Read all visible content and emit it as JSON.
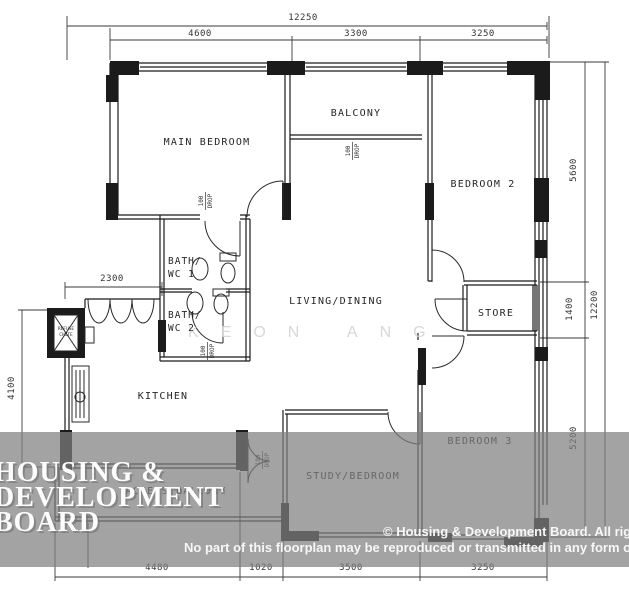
{
  "plan": {
    "rooms": {
      "main_bedroom": "MAIN BEDROOM",
      "balcony": "BALCONY",
      "bedroom2": "BEDROOM 2",
      "living": "LIVING/DINING",
      "store": "STORE",
      "kitchen": "KITCHEN",
      "bedroom3": "BEDROOM 3",
      "study": "STUDY/BEDROOM",
      "access_balcony": "ACCESS BALCONY",
      "bath1_line1": "BATH/",
      "bath1_line2": "WC 1",
      "bath2_line1": "BATH/",
      "bath2_line2": "WC 2"
    },
    "notes": {
      "drop_value": "100",
      "drop_word": "DROP",
      "refuse_line1": "REFUSE",
      "refuse_line2": "CHUTE"
    },
    "dimensions": {
      "top_overall": "12250",
      "top_seg1": "4600",
      "top_seg2": "3300",
      "top_seg3": "3250",
      "right_seg1": "5600",
      "right_seg2": "1400",
      "right_seg3": "5200",
      "right_overall": "12200",
      "left_width": "2300",
      "left_height": "4100",
      "bottom_seg1": "4480",
      "bottom_seg2": "1020",
      "bottom_seg3": "3500",
      "bottom_seg4": "3250"
    }
  },
  "watermark": {
    "line1": "HOUSING &",
    "line2": "DEVELOPMENT",
    "line3": "BOARD",
    "agent": "KEON ANG"
  },
  "copyright": {
    "line1": "© Housing & Development Board. All rights",
    "line2": "No part of this floorplan may be reproduced or transmitted in any form or by a"
  },
  "colors": {
    "wall": "#1b1b1b",
    "dimension": "#3a3a3a",
    "band": "#7f7f7f",
    "watermark_text": "#fcfcfc",
    "agent_watermark": "#d4d4d4"
  }
}
